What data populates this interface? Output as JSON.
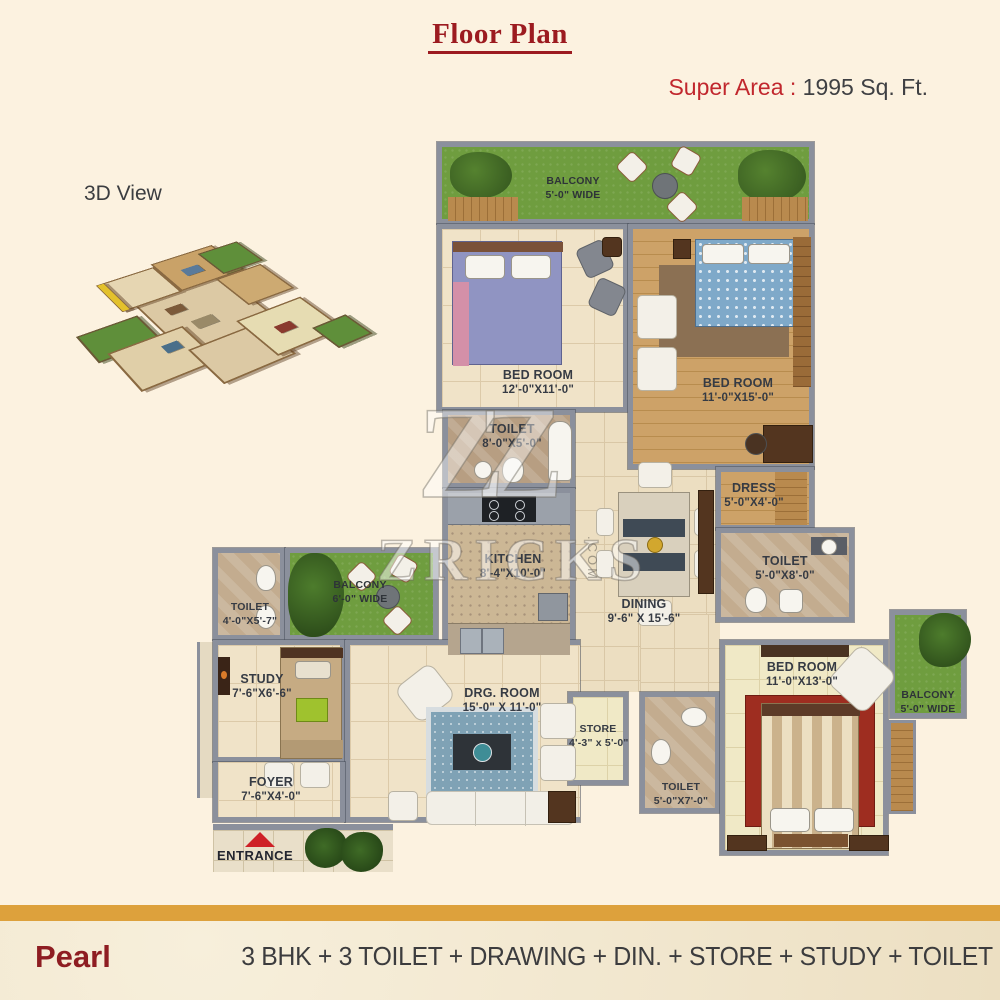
{
  "title": "Floor Plan",
  "super_area": {
    "label": "Super Area :",
    "value": " 1995 Sq. Ft."
  },
  "view_3d_label": "3D View",
  "watermark": {
    "logo": "ZZ",
    "text": "ZRICKS",
    "suffix": ".COM"
  },
  "rooms": {
    "balcony_top": {
      "name": "BALCONY",
      "dims": "5'-0\" WIDE"
    },
    "bedroom1": {
      "name": "BED ROOM",
      "dims": "12'-0\"X11'-0\""
    },
    "bedroom2": {
      "name": "BED ROOM",
      "dims": "11'-0\"X15'-0\""
    },
    "toilet1": {
      "name": "TOILET",
      "dims": "8'-0\"X5'-0\""
    },
    "kitchen": {
      "name": "KITCHEN",
      "dims": "8'-4\"X10'-0\""
    },
    "dining": {
      "name": "DINING",
      "dims": "9'-6\" X 15'-6\""
    },
    "dress": {
      "name": "DRESS",
      "dims": "5'-0\"X4'-0\""
    },
    "toilet2": {
      "name": "TOILET",
      "dims": "5'-0\"X8'-0\""
    },
    "toilet_left": {
      "name": "TOILET",
      "dims": "4'-0\"X5'-7\""
    },
    "balcony_left": {
      "name": "BALCONY",
      "dims": "6'-0\" WIDE"
    },
    "study": {
      "name": "STUDY",
      "dims": "7'-6\"X6'-6\""
    },
    "drg_room": {
      "name": "DRG. ROOM",
      "dims": "15'-0\" X 11'-0\""
    },
    "foyer": {
      "name": "FOYER",
      "dims": "7'-6\"X4'-0\""
    },
    "store": {
      "name": "STORE",
      "dims": "4'-3\" x 5'-0\""
    },
    "toilet3": {
      "name": "TOILET",
      "dims": "5'-0\"X7'-0\""
    },
    "bedroom3": {
      "name": "BED ROOM",
      "dims": "11'-0\"X13'-0\""
    },
    "balcony_right": {
      "name": "BALCONY",
      "dims": "5'-0\" WIDE"
    }
  },
  "entrance_label": "ENTRANCE",
  "footer": {
    "project": "Pearl",
    "config": "3 BHK + 3 TOILET + DRAWING + DIN. + STORE + STUDY + TOILET"
  },
  "colors": {
    "background": "#fcf2e0",
    "title_red": "#9c1b20",
    "accent_red": "#c1272d",
    "gold_bar": "#dda13c",
    "text_dark": "#3c3c3e",
    "wall_gray": "#8b909c",
    "grass_green": "#6f9d3f",
    "wood_floor": "#cda268",
    "entrance_red": "#ce2027"
  }
}
